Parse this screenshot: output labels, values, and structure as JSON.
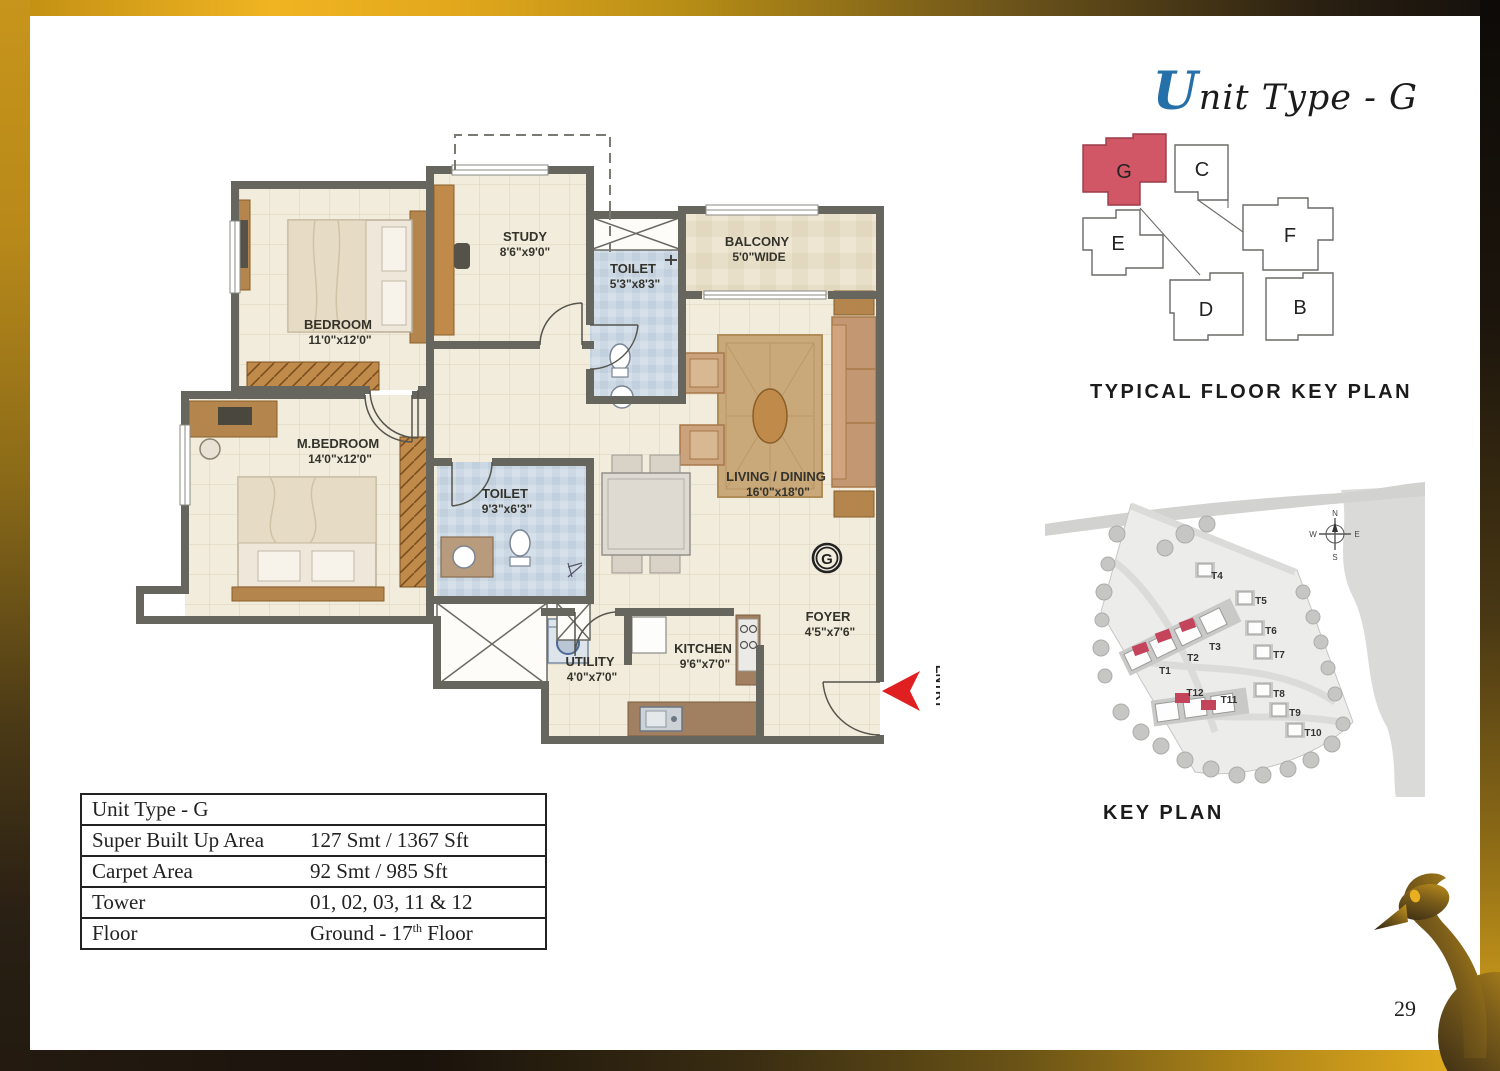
{
  "page": {
    "number": "29"
  },
  "header": {
    "title_initial": "U",
    "title_rest": "nit Type - G"
  },
  "floorplan": {
    "rooms": [
      {
        "id": "bedroom",
        "name": "BEDROOM",
        "dims": "11'0\"x12'0\""
      },
      {
        "id": "study",
        "name": "STUDY",
        "dims": "8'6\"x9'0\""
      },
      {
        "id": "toilet1",
        "name": "TOILET",
        "dims": "5'3\"x8'3\""
      },
      {
        "id": "balcony",
        "name": "BALCONY",
        "dims": "5'0\"WIDE"
      },
      {
        "id": "living",
        "name": "LIVING / DINING",
        "dims": "16'0\"x18'0\""
      },
      {
        "id": "mbedroom",
        "name": "M.BEDROOM",
        "dims": "14'0\"x12'0\""
      },
      {
        "id": "toilet2",
        "name": "TOILET",
        "dims": "9'3\"x6'3\""
      },
      {
        "id": "utility",
        "name": "UTILITY",
        "dims": "4'0\"x7'0\""
      },
      {
        "id": "kitchen",
        "name": "KITCHEN",
        "dims": "9'6\"x7'0\""
      },
      {
        "id": "foyer",
        "name": "FOYER",
        "dims": "4'5\"x7'6\""
      }
    ],
    "entry_label": "ENTRY",
    "unit_marker": "G"
  },
  "typical_floor_key_plan": {
    "caption": "TYPICAL FLOOR KEY PLAN",
    "highlighted_unit": "G",
    "highlight_color": "#d15767",
    "units": [
      {
        "label": "G"
      },
      {
        "label": "C"
      },
      {
        "label": "E"
      },
      {
        "label": "F"
      },
      {
        "label": "D"
      },
      {
        "label": "B"
      }
    ]
  },
  "site_key_plan": {
    "caption": "KEY PLAN",
    "towers": [
      "T1",
      "T2",
      "T3",
      "T4",
      "T5",
      "T6",
      "T7",
      "T8",
      "T9",
      "T10",
      "T11",
      "T12"
    ],
    "highlighted_towers": [
      "T1",
      "T2",
      "T3",
      "T11",
      "T12"
    ],
    "highlight_color": "#c4445c",
    "compass": {
      "n": "N",
      "e": "E",
      "s": "S",
      "w": "W"
    }
  },
  "details_table": {
    "rows": {
      "unit_type": {
        "label": "Unit Type - G"
      },
      "super_area": {
        "label": "Super Built Up Area",
        "value": "127 Smt / 1367 Sft"
      },
      "carpet": {
        "label": "Carpet Area",
        "value": "92 Smt / 985 Sft"
      },
      "tower": {
        "label": "Tower",
        "value": "01, 02, 03, 11 & 12"
      },
      "floor": {
        "label": "Floor",
        "value_prefix": "Ground - 17",
        "value_sup": "th",
        "value_suffix": " Floor"
      }
    }
  }
}
